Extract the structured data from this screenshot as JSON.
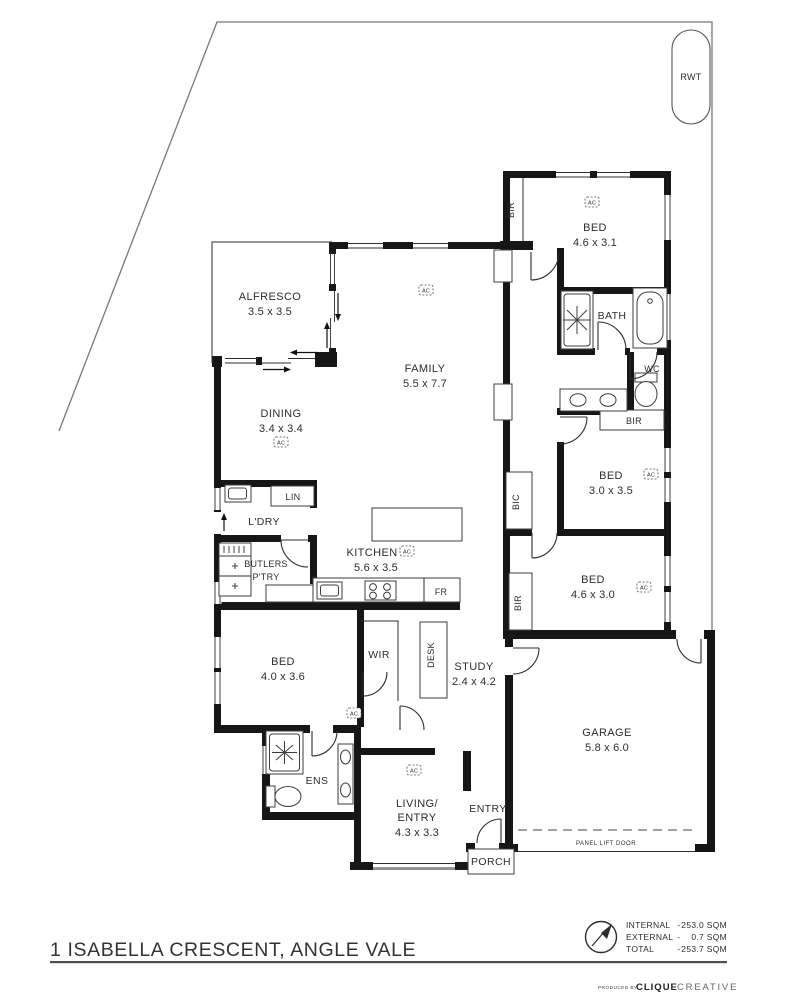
{
  "site": {
    "tank": "RWT"
  },
  "labels": {
    "ac": "AC",
    "bir": "BIR",
    "bic": "BIC",
    "lin": "LIN",
    "ldry": "L'DRY",
    "butlers_1": "BUTLERS",
    "butlers_2": "P'TRY",
    "wir": "WIR",
    "desk": "DESK",
    "fr": "FR",
    "panel_lift_door": "PANEL LIFT DOOR"
  },
  "rooms": {
    "alfresco": {
      "name": "ALFRESCO",
      "dims": "3.5 x 3.5"
    },
    "family": {
      "name": "FAMILY",
      "dims": "5.5 x 7.7"
    },
    "dining": {
      "name": "DINING",
      "dims": "3.4 x 3.4"
    },
    "kitchen": {
      "name": "KITCHEN",
      "dims": "5.6 x 3.5"
    },
    "bed_1": {
      "name": "BED",
      "dims": "4.6 x 3.1"
    },
    "bath": {
      "name": "BATH"
    },
    "wc": {
      "name": "WC"
    },
    "bed_2": {
      "name": "BED",
      "dims": "3.0 x 3.5"
    },
    "bed_3": {
      "name": "BED",
      "dims": "4.6 x 3.0"
    },
    "master_bed": {
      "name": "BED",
      "dims": "4.0 x 3.6"
    },
    "study": {
      "name": "STUDY",
      "dims": "2.4 x 4.2"
    },
    "living": {
      "line1": "LIVING/",
      "line2": "ENTRY",
      "dims": "4.3 x 3.3"
    },
    "entry": {
      "name": "ENTRY"
    },
    "porch": {
      "name": "PORCH"
    },
    "ens": {
      "name": "ENS"
    },
    "garage": {
      "name": "GARAGE",
      "dims": "5.8 x 6.0"
    }
  },
  "footer": {
    "address": "1 ISABELLA CRESCENT, ANGLE VALE",
    "areas": [
      {
        "label": "INTERNAL",
        "dash": "-",
        "value": "253.0 SQM"
      },
      {
        "label": "EXTERNAL",
        "dash": "-",
        "value": "0.7 SQM"
      },
      {
        "label": "TOTAL",
        "dash": "-",
        "value": "253.7 SQM"
      }
    ],
    "produced_by": "PRODUCED BY",
    "brand_strong": "CLIQUE",
    "brand_light": "CREATIVE"
  },
  "colors": {
    "wall": "#161616",
    "boundary": "#787878",
    "text": "#2d2d2d"
  }
}
